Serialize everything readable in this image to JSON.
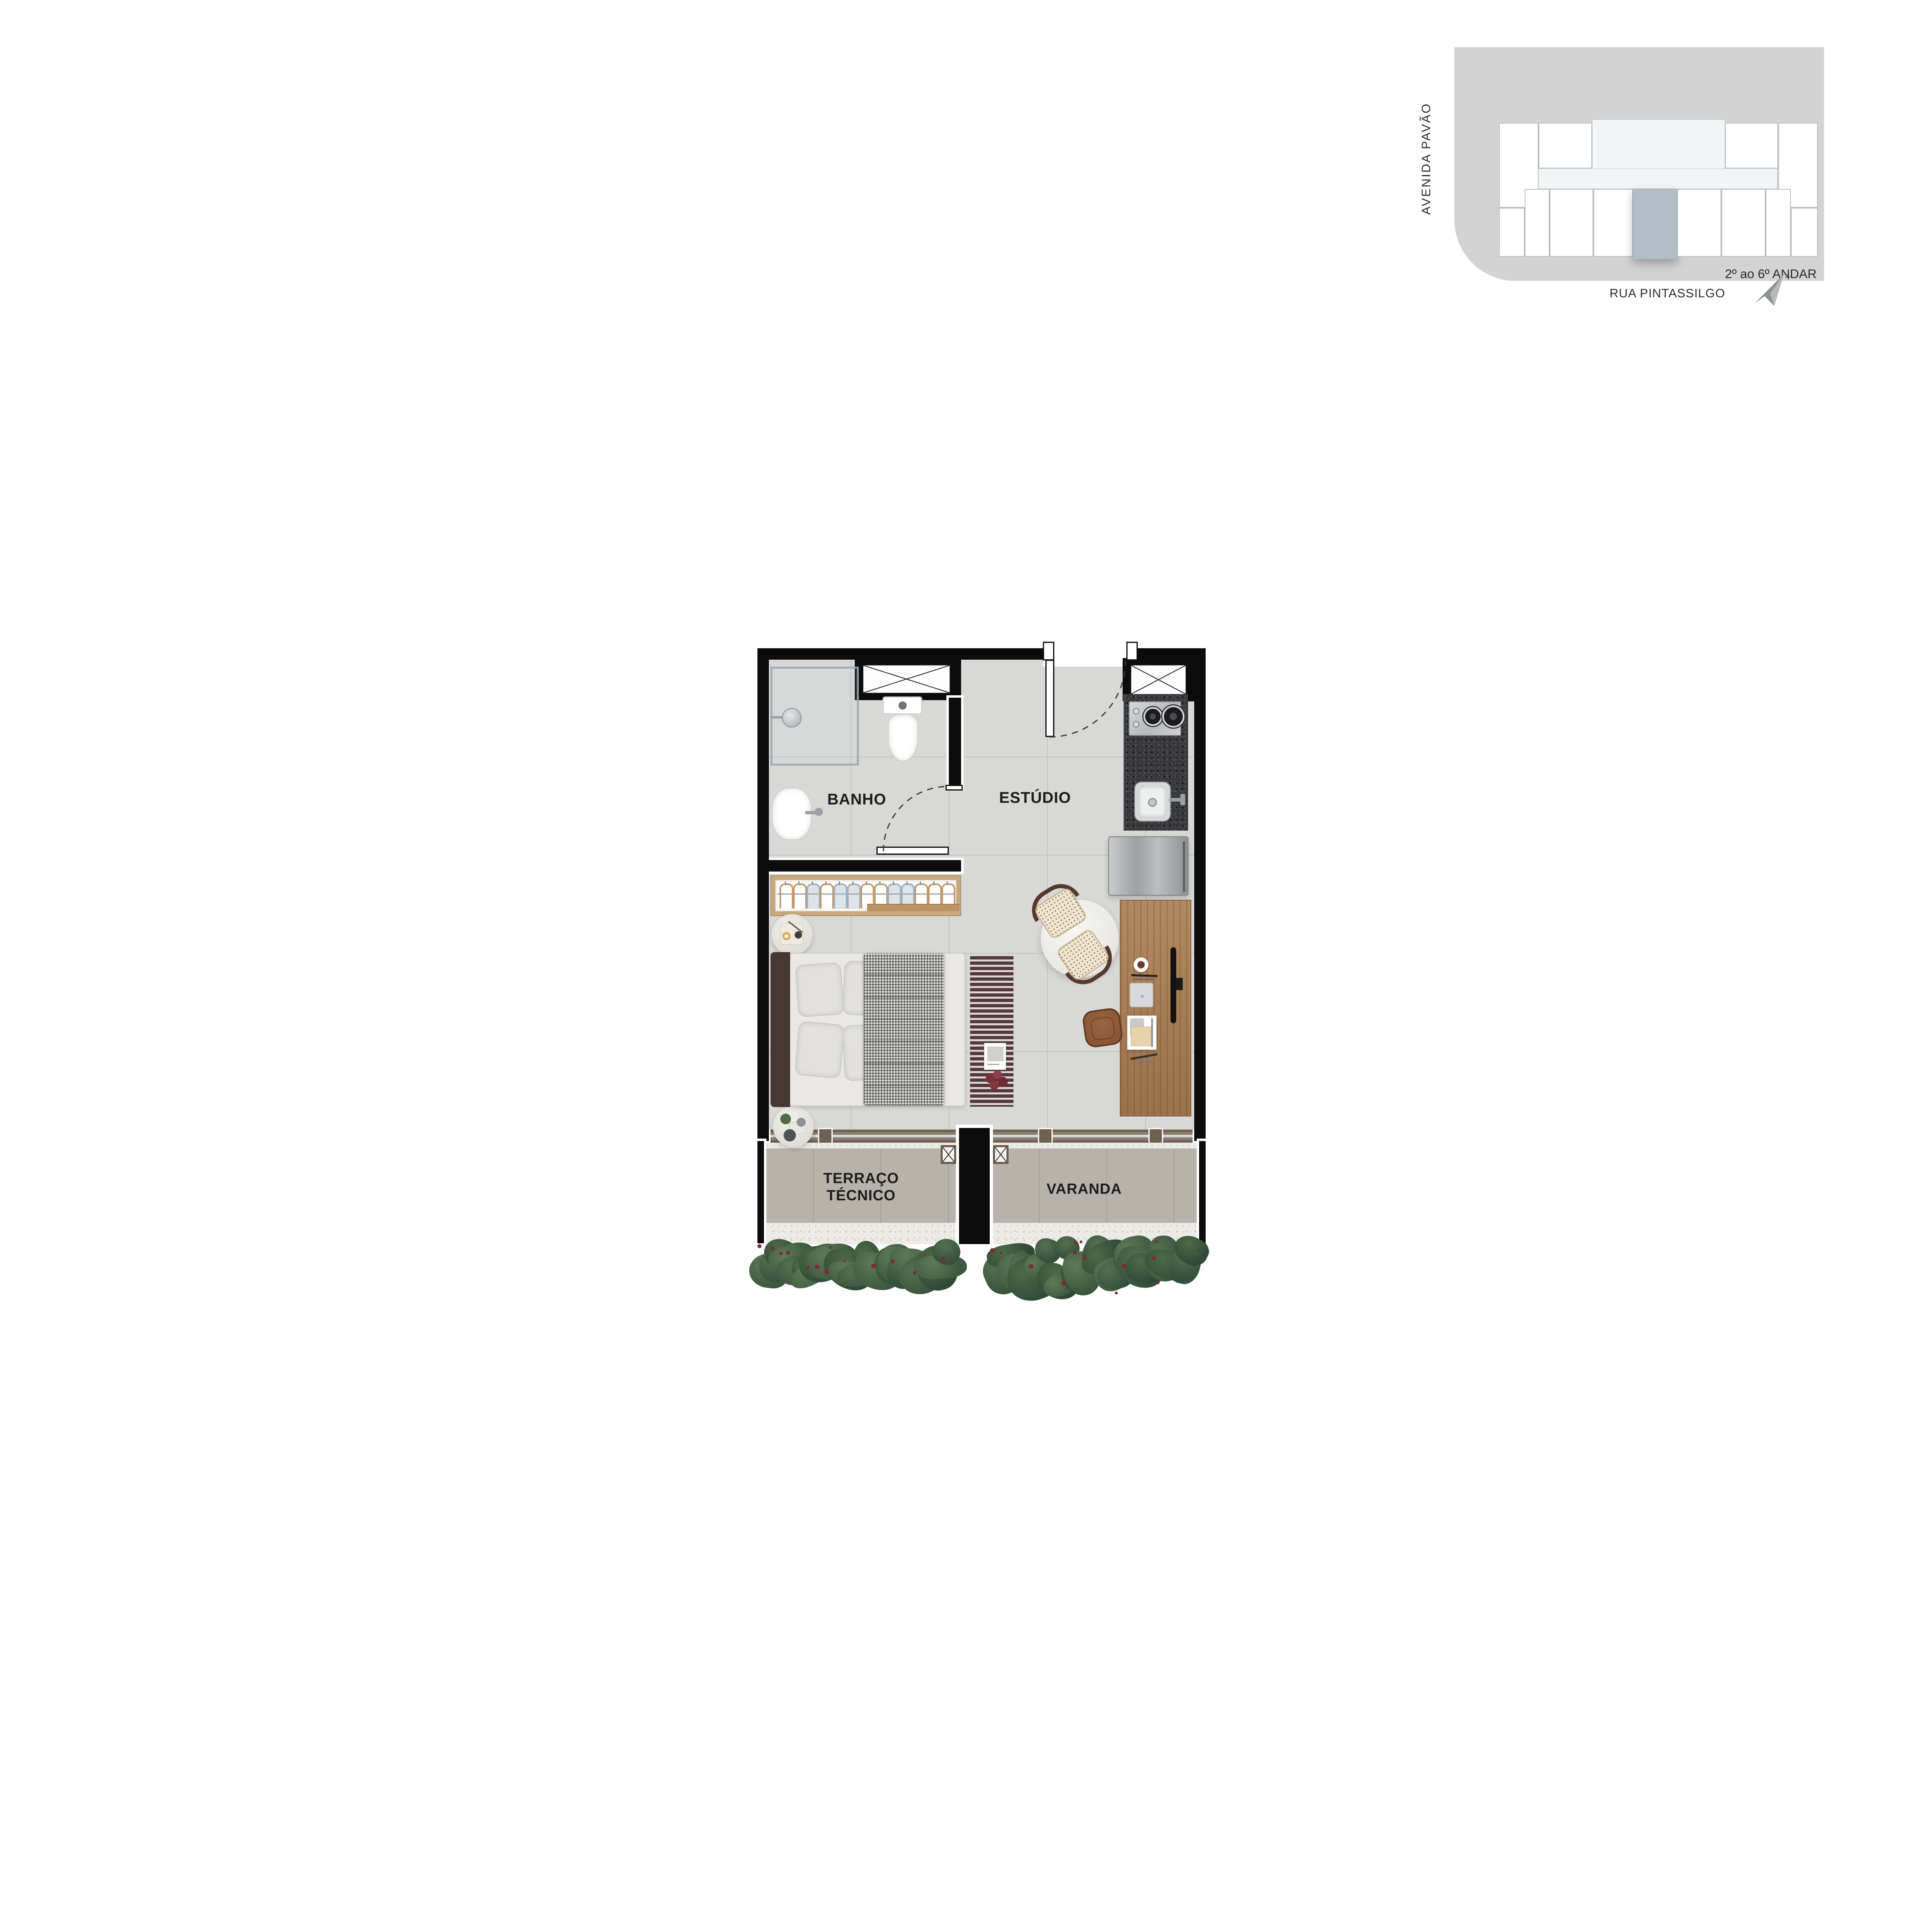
{
  "keyplan": {
    "street_left_label": "AVENIDA PAVÃO",
    "street_bottom_label": "RUA PINTASSILGO",
    "floors_label": "2º ao 6º ANDAR",
    "north_label": "N"
  },
  "plan": {
    "labels": {
      "bathroom": "BANHO",
      "studio": "ESTÚDIO",
      "technical_terrace": "TERRAÇO TÉCNICO",
      "balcony": "VARANDA"
    },
    "closet": {
      "hanger_pattern": [
        "wood",
        "wood",
        "cloth",
        "wood",
        "cloth",
        "cloth",
        "wood",
        "wood",
        "cloth",
        "cloth",
        "wood",
        "wood",
        "wood"
      ]
    },
    "hedge": {
      "blob_count": 26,
      "berry_count": 14
    }
  },
  "icons": {
    "north": "north-arrow-icon",
    "vent_shaft": "vent-shaft-icon",
    "shower": "shower-head-icon",
    "toilet": "toilet-icon",
    "bath_sink": "bathroom-sink-icon",
    "cooktop": "cooktop-icon",
    "kitchen_sink": "kitchen-sink-icon",
    "fridge": "fridge-icon",
    "tv": "tv-icon"
  },
  "colors": {
    "wall": "#0c0c0c",
    "floor": "#d8d8d6",
    "floor_line": "#c2c2c0",
    "terrace_floor": "#b8b2aa",
    "terrace_line": "#a49e96",
    "gravel": "#ecebe6",
    "gravel_dot1": "#c9c6bf",
    "gravel_dot2": "#b3b0aa",
    "track": "#8d7d6e",
    "track_dark": "#6f6152",
    "glass": "#ccd7d7",
    "granite": "#39393b",
    "granite_dot1": "#57575b",
    "granite_dot2": "#101012",
    "wood_desk": "#a87c50",
    "wood_closet": "#c9a87e",
    "runner": "#563740",
    "headboard": "#463830",
    "mattress": "#e9e8e5",
    "pillow": "#e2e1de",
    "blanket_base": "#e8e7e4",
    "table": "#f2f1ee",
    "cane_seat": "#efe6d2",
    "cane_dot": "#8a6a4a",
    "cane_frame": "#56382e",
    "leather": "#8a5636",
    "leather_dark": "#5f3a22",
    "site": "#d2d3d2",
    "core": "#f3f4f5",
    "unit_border": "#b9bfc0",
    "highlight": "#b1bec5",
    "hedge1a": "#5d7a58",
    "hedge1b": "#3d583d",
    "hedge2a": "#557050",
    "hedge2b": "#35503a",
    "hedge3a": "#4d6a49",
    "hedge3b": "#2f4a34",
    "berry": "#7a2e33",
    "label": "#1c1c1c",
    "metal": "#9aa0a3"
  }
}
